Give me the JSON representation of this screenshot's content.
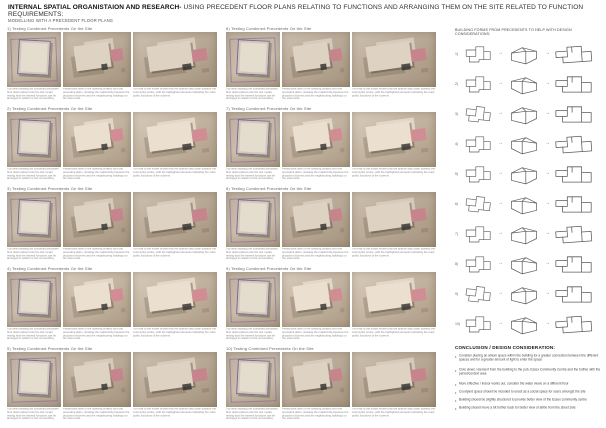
{
  "header": {
    "title_bold": "INTERNAL SPATIAL ORGANISTAION AND RESEARCH-",
    "title_rest": " USING PRECEDENT FLOOR PLANS RELATING TO FUNCTIONS AND ARRANGING THEM ON THE SITE RELATED TO FUNCTION REQUIREMENTS:",
    "subtitle": "MODELLING WITH A PRECEDENT FLOOR PLANS"
  },
  "left_sections": [
    {
      "label": "1) Testing Combined Precedents On the Site",
      "captions": [
        "Top view showing the combined precedent floor plans placed onto the site model, testing how the internal functions can be arranged in relation to the surrounding context.",
        "Perspective view of the massing created from the precedent plans, showing the relationship between the proposed volumes and the neighbouring buildings on the street side.",
        "The rear of the model shows how the spaces step down towards the community centre, with the highlighted elements indicating the main public functions of the scheme."
      ]
    },
    {
      "label": "2) Testing Combined Precedents On the Site",
      "captions": [
        "Top view showing the combined precedent floor plans placed onto the site model, testing how the internal functions can be arranged in relation to the surrounding context.",
        "Perspective view of the massing created from the precedent plans, showing the relationship between the proposed volumes and the neighbouring buildings on the street side.",
        "The rear of the model shows how the spaces step down towards the community centre, with the highlighted elements indicating the main public functions of the scheme."
      ]
    },
    {
      "label": "3) Testing Combined Precedents On the Site",
      "captions": [
        "Top view showing the combined precedent floor plans placed onto the site model, testing how the internal functions can be arranged in relation to the surrounding context.",
        "Perspective view of the massing created from the precedent plans, showing the relationship between the proposed volumes and the neighbouring buildings on the street side.",
        "The rear of the model shows how the spaces step down towards the community centre, with the highlighted elements indicating the main public functions of the scheme."
      ]
    },
    {
      "label": "4) Testing Combined Precedents On the Site",
      "captions": [
        "Top view showing the combined precedent floor plans placed onto the site model, testing how the internal functions can be arranged in relation to the surrounding context.",
        "Perspective view of the massing created from the precedent plans, showing the relationship between the proposed volumes and the neighbouring buildings on the street side.",
        "The rear of the model shows how the spaces step down towards the community centre, with the highlighted elements indicating the main public functions of the scheme."
      ]
    },
    {
      "label": "5) Testing Combined Precedents On the Site",
      "captions": [
        "Top view showing the combined precedent floor plans placed onto the site model, testing how the internal functions can be arranged in relation to the surrounding context.",
        "Perspective view of the massing created from the precedent plans, showing the relationship between the proposed volumes and the neighbouring buildings on the street side.",
        "The rear of the model shows how the spaces step down towards the community centre, with the highlighted elements indicating the main public functions of the scheme."
      ]
    }
  ],
  "middle_sections": [
    {
      "label": "6) Testing Combined Precedents On the Site",
      "captions": [
        "Top view showing the combined precedent floor plans placed onto the site model, testing how the internal functions can be arranged in relation to the surrounding context.",
        "Perspective view of the massing created from the precedent plans, showing the relationship between the proposed volumes and the neighbouring buildings on the street side.",
        "The rear of the model shows how the spaces step down towards the community centre, with the highlighted elements indicating the main public functions of the scheme."
      ]
    },
    {
      "label": "7) Testing Combined Precedents On the Site",
      "captions": [
        "Top view showing the combined precedent floor plans placed onto the site model, testing how the internal functions can be arranged in relation to the surrounding context.",
        "Perspective view of the massing created from the precedent plans, showing the relationship between the proposed volumes and the neighbouring buildings on the street side.",
        "The rear of the model shows how the spaces step down towards the community centre, with the highlighted elements indicating the main public functions of the scheme."
      ]
    },
    {
      "label": "8) Testing Combined Precedents On the Site",
      "captions": [
        "Top view showing the combined precedent floor plans placed onto the site model, testing how the internal functions can be arranged in relation to the surrounding context.",
        "Perspective view of the massing created from the precedent plans, showing the relationship between the proposed volumes and the neighbouring buildings on the street side.",
        "The rear of the model shows how the spaces step down towards the community centre, with the highlighted elements indicating the main public functions of the scheme."
      ]
    },
    {
      "label": "9) Testing Combined Precedents On the Site",
      "captions": [
        "Top view showing the combined precedent floor plans placed onto the site model, testing how the internal functions can be arranged in relation to the surrounding context.",
        "Perspective view of the massing created from the precedent plans, showing the relationship between the proposed volumes and the neighbouring buildings on the street side.",
        "The rear of the model shows how the spaces step down towards the community centre, with the highlighted elements indicating the main public functions of the scheme."
      ]
    },
    {
      "label": "10) Testing Combined Precedents On the Site",
      "captions": [
        "Top view showing the combined precedent floor plans placed onto the site model, testing how the internal functions can be arranged in relation to the surrounding context.",
        "Perspective view of the massing created from the precedent plans, showing the relationship between the proposed volumes and the neighbouring buildings on the street side.",
        "The rear of the model shows how the spaces step down towards the community centre, with the highlighted elements indicating the main public functions of the scheme."
      ]
    }
  ],
  "right_panel": {
    "header": "BUILDING FORMS FROM PRECEDENTS TO HELP WITH DESIGN CONSIDERATIONS:",
    "rows": [
      "1)",
      "2)",
      "3)",
      "4)",
      "5)",
      "6)",
      "7)",
      "8)",
      "9)",
      "10)"
    ],
    "conclusion_title": "CONCLUSION / DESIGN CONSIDERATION:",
    "bullets": [
      "Consider placing an atrium space within the building for a greater connection between the different spaces and for a greater amount of light to enter the space",
      "Civic views / element from the building to the pub, Essex Community Centre and the further with the period/context area",
      "More effective / indoor works out, consider the water views on a different floor",
      "Courtyard space should be included to enact as a social space for users amongst the site",
      "Building should be slightly structured to provide better view of the Essex community centre",
      "Building should move a bit further back for better view of all/be from the street side"
    ]
  },
  "colors": {
    "board_bg": "#ffffff",
    "model_tan": "#b9ab99",
    "accent_pink": "#c4868c",
    "plan_purple": "#7a6a85",
    "sketch_stroke": "#5c5c5c",
    "text_dark": "#1a1a1a",
    "text_gray": "#8a8a8a"
  }
}
